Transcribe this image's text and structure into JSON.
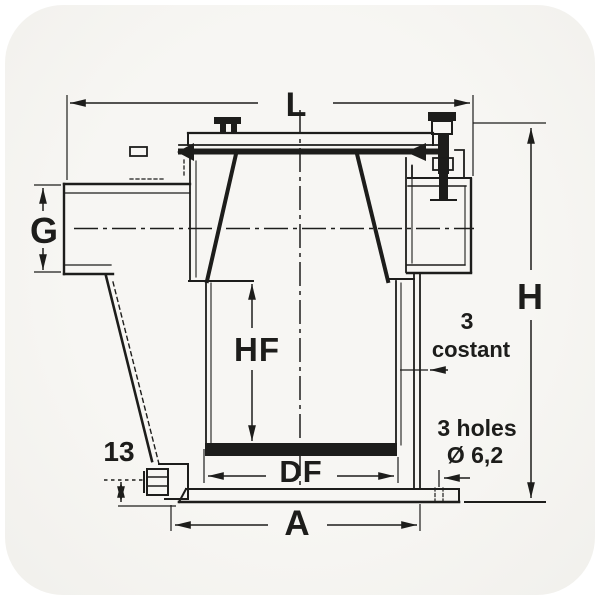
{
  "labels": {
    "overall_length": "L",
    "inlet_thread": "G",
    "overall_height": "H",
    "filter_height": "HF",
    "filter_diameter": "DF",
    "base_width": "A",
    "drain_offset": "13"
  },
  "notes": {
    "wall_thickness_value": "3",
    "wall_thickness_word": "costant",
    "mounting_holes_line1": "3 holes",
    "mounting_holes_line2": "Ø 6,2"
  },
  "colors": {
    "ink": "#20201e",
    "paper": "#f5f4f1",
    "page": "#ffffff"
  }
}
